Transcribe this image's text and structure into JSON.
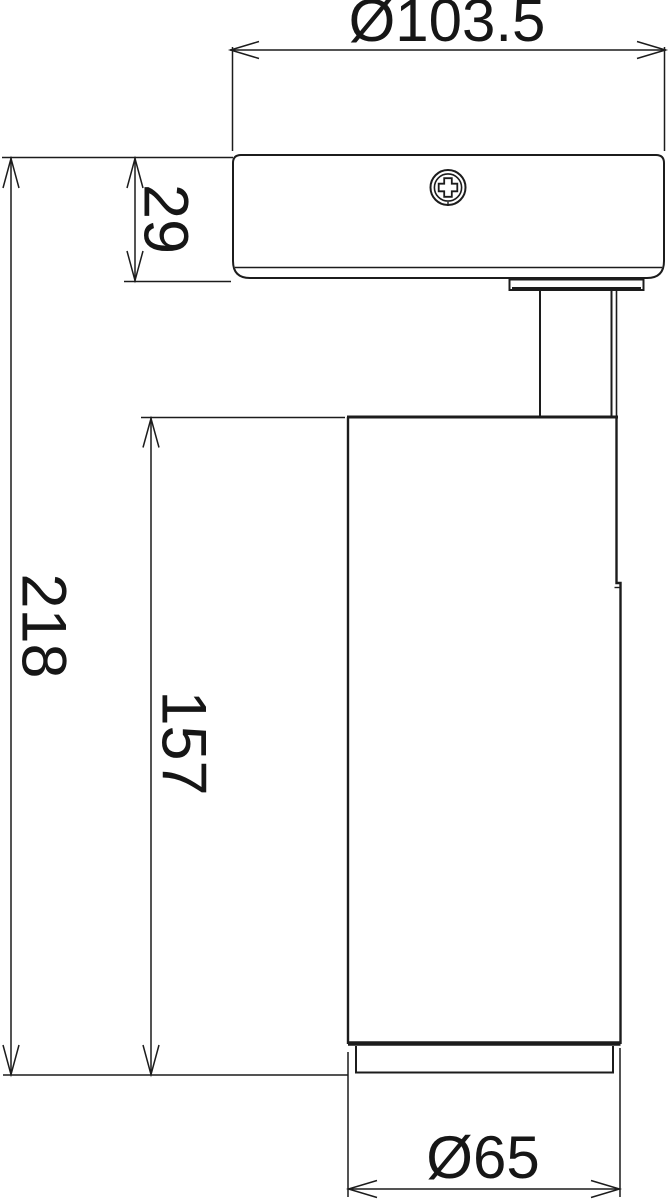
{
  "meta": {
    "background_color": "#ffffff",
    "line_color": "#1c1c1c",
    "text_color": "#161616"
  },
  "drawing": {
    "type": "technical-dimension-drawing",
    "dimension_labels": {
      "head_diameter": "Ø103.5",
      "canopy_height": "29",
      "total_height": "218",
      "body_height": "157",
      "body_diameter": "Ø65"
    },
    "icons": [
      {
        "name": "phillips-screw-icon"
      }
    ]
  }
}
